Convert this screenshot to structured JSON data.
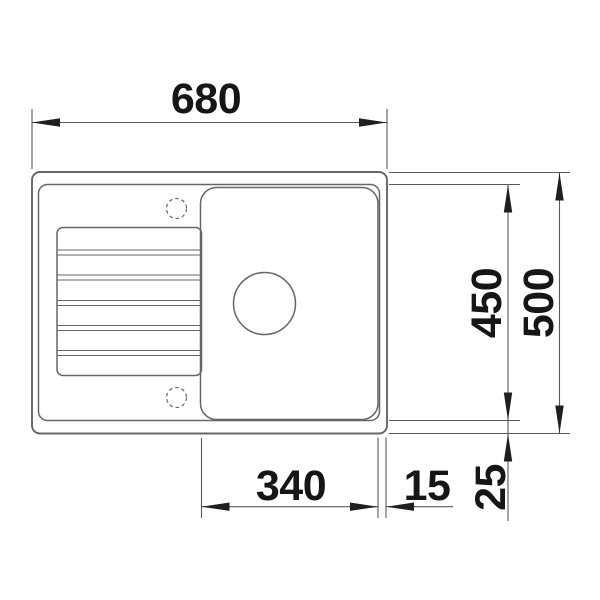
{
  "colors": {
    "background": "#ffffff",
    "outline": "#666666",
    "line": "#595959",
    "arrow": "#1f1f1f",
    "text": "#161616"
  },
  "dimensions": {
    "overall_width": "680",
    "overall_depth": "500",
    "inner_depth": "450",
    "bowl_width": "340",
    "rim_right": "15",
    "rim_bottom": "25"
  }
}
